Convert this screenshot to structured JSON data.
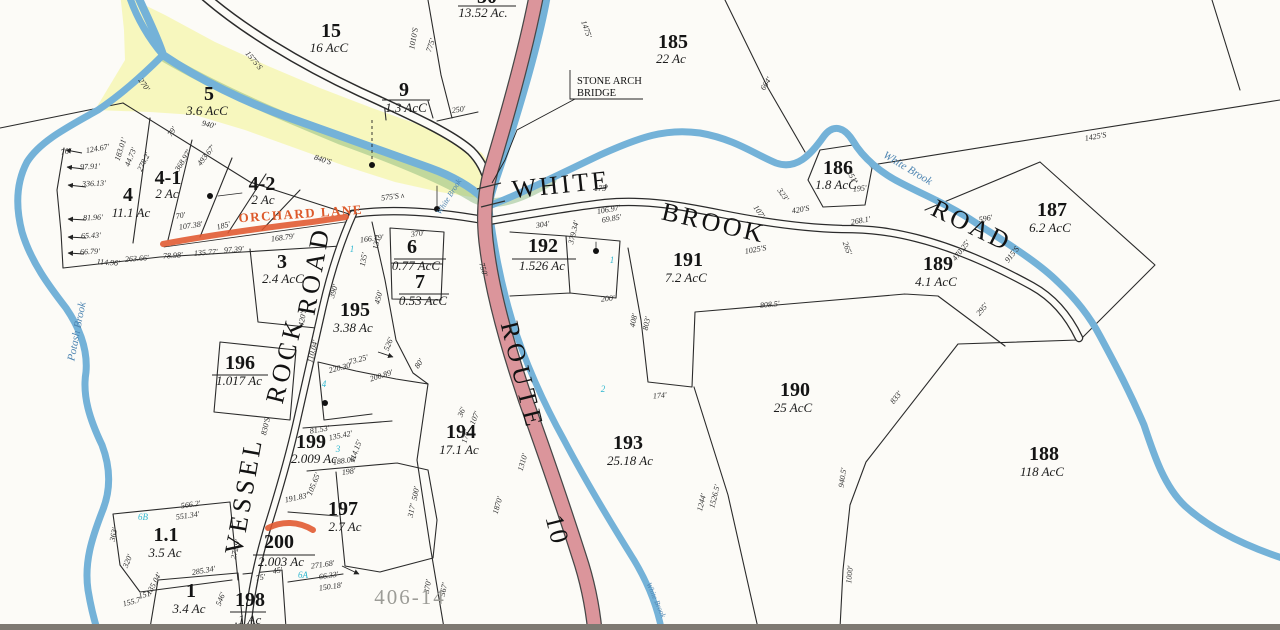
{
  "annotations": {
    "bridge_note_line1": "STONE ARCH",
    "bridge_note_line2": "BRIDGE",
    "sheet_ref": "406-14"
  },
  "colors": {
    "water": "#74b2d8",
    "route_fill": "#db959b",
    "floodplain": "#f7f7ba",
    "green_tinge": "#7fb274",
    "highlight": "#e0562e",
    "teal_marker": "#2fb7d0",
    "line": "#2b2b2b",
    "sheet_gray": "#9c9c97",
    "water_text": "#4e85b2"
  },
  "road_labels": [
    {
      "t": "WHITE",
      "x": 562,
      "y": 193,
      "r": -6,
      "s": 26,
      "ls": 3
    },
    {
      "t": "BROOK",
      "x": 712,
      "y": 231,
      "r": 13,
      "s": 26,
      "ls": 3
    },
    {
      "t": "ROAD",
      "x": 968,
      "y": 233,
      "r": 26,
      "s": 26,
      "ls": 3
    },
    {
      "t": "VESSEL",
      "x": 252,
      "y": 497,
      "r": -80,
      "s": 27,
      "ls": 4
    },
    {
      "t": "ROCK",
      "x": 293,
      "y": 362,
      "r": -76,
      "s": 27,
      "ls": 4
    },
    {
      "t": "ROAD",
      "x": 322,
      "y": 272,
      "r": -80,
      "s": 27,
      "ls": 4
    },
    {
      "t": "ROUTE",
      "x": 514,
      "y": 378,
      "r": 76,
      "s": 25,
      "ls": 5
    },
    {
      "t": "10",
      "x": 549,
      "y": 532,
      "r": 76,
      "s": 25,
      "ls": 2
    },
    {
      "t": "ORCHARD LANE",
      "x": 301,
      "y": 218,
      "r": -4,
      "s": 13,
      "ls": 1.5,
      "c": "#dd5a2b"
    }
  ],
  "water_labels": [
    {
      "t": "Potash Brook",
      "x": 80,
      "y": 332,
      "r": -79,
      "s": 11
    },
    {
      "t": "White Brook",
      "x": 906,
      "y": 171,
      "r": 31,
      "s": 11
    },
    {
      "t": "White Brook",
      "x": 451,
      "y": 198,
      "r": -58,
      "s": 8
    },
    {
      "t": "White Brook",
      "x": 654,
      "y": 601,
      "r": 66,
      "s": 7.5
    }
  ],
  "parcels": [
    {
      "id": "30",
      "ac": "13.52 Ac.",
      "x": 487,
      "y": 3,
      "ax": 483,
      "ay": 17
    },
    {
      "id": "15",
      "ac": "16 AcC",
      "x": 331,
      "y": 37,
      "ax": 329,
      "ay": 52
    },
    {
      "id": "5",
      "ac": "3.6 AcC",
      "x": 209,
      "y": 100,
      "ax": 207,
      "ay": 115
    },
    {
      "id": "9",
      "ac": "1.3 AcC",
      "x": 404,
      "y": 96,
      "ax": 406,
      "ay": 112
    },
    {
      "id": "185",
      "ac": "22 Ac",
      "x": 673,
      "y": 48,
      "ax": 671,
      "ay": 63
    },
    {
      "id": "186",
      "ac": "1.8 AcC",
      "x": 838,
      "y": 174,
      "ax": 836,
      "ay": 189
    },
    {
      "id": "187",
      "ac": "6.2 AcC",
      "x": 1052,
      "y": 216,
      "ax": 1050,
      "ay": 232
    },
    {
      "id": "189",
      "ac": "4.1 AcC",
      "x": 938,
      "y": 270,
      "ax": 936,
      "ay": 286
    },
    {
      "id": "191",
      "ac": "7.2 AcC",
      "x": 688,
      "y": 266,
      "ax": 686,
      "ay": 282
    },
    {
      "id": "192",
      "ac": "1.526 Ac",
      "x": 543,
      "y": 252,
      "ax": 542,
      "ay": 270
    },
    {
      "id": "4",
      "ac": "11.1 Ac",
      "x": 128,
      "y": 201,
      "ax": 131,
      "ay": 217
    },
    {
      "id": "4-1",
      "ac": "2 Ac",
      "x": 168,
      "y": 184,
      "ax": 167,
      "ay": 198
    },
    {
      "id": "4-2",
      "ac": "2 Ac",
      "x": 262,
      "y": 190,
      "ax": 263,
      "ay": 204
    },
    {
      "id": "3",
      "ac": "2.4 AcC",
      "x": 282,
      "y": 268,
      "ax": 283,
      "ay": 283
    },
    {
      "id": "6",
      "ac": "0.77 AcC",
      "x": 412,
      "y": 253,
      "ax": 416,
      "ay": 270
    },
    {
      "id": "7",
      "ac": "0.53 AcC",
      "x": 420,
      "y": 288,
      "ax": 423,
      "ay": 305
    },
    {
      "id": "195",
      "ac": "3.38 Ac",
      "x": 355,
      "y": 316,
      "ax": 353,
      "ay": 332
    },
    {
      "id": "196",
      "ac": "1.017 Ac",
      "x": 240,
      "y": 369,
      "ax": 239,
      "ay": 385
    },
    {
      "id": "199",
      "ac": "2.009 Ac",
      "x": 311,
      "y": 448,
      "ax": 314,
      "ay": 463
    },
    {
      "id": "197",
      "ac": "2.7 Ac",
      "x": 343,
      "y": 515,
      "ax": 345,
      "ay": 531
    },
    {
      "id": "200",
      "ac": "2.003 Ac",
      "x": 279,
      "y": 548,
      "ax": 281,
      "ay": 566
    },
    {
      "id": "1.1",
      "ac": "3.5 Ac",
      "x": 166,
      "y": 541,
      "ax": 165,
      "ay": 557
    },
    {
      "id": "1",
      "ac": "3.4 Ac",
      "x": 191,
      "y": 597,
      "ax": 189,
      "ay": 613
    },
    {
      "id": "198",
      "ac": ".1 Ac",
      "x": 250,
      "y": 606,
      "ax": 248,
      "ay": 624
    },
    {
      "id": "194",
      "ac": "17.1 Ac",
      "x": 461,
      "y": 438,
      "ax": 459,
      "ay": 454
    },
    {
      "id": "193",
      "ac": "25.18 Ac",
      "x": 628,
      "y": 449,
      "ax": 630,
      "ay": 465
    },
    {
      "id": "190",
      "ac": "25 AcC",
      "x": 795,
      "y": 396,
      "ax": 793,
      "ay": 412
    },
    {
      "id": "188",
      "ac": "118 AcC",
      "x": 1044,
      "y": 460,
      "ax": 1042,
      "ay": 476
    }
  ],
  "measurements": [
    {
      "t": "76'",
      "x": 66,
      "y": 154,
      "r": -10
    },
    {
      "t": "124.67'",
      "x": 98,
      "y": 151,
      "r": -10
    },
    {
      "t": "97.91'",
      "x": 90,
      "y": 169,
      "r": -2
    },
    {
      "t": "336.13'",
      "x": 94,
      "y": 186,
      "r": -2
    },
    {
      "t": "81.96'",
      "x": 93,
      "y": 220,
      "r": -2
    },
    {
      "t": "65.43'",
      "x": 91,
      "y": 238,
      "r": -2
    },
    {
      "t": "66.79'",
      "x": 90,
      "y": 254,
      "r": -2
    },
    {
      "t": "114.96'",
      "x": 108,
      "y": 265,
      "r": 4
    },
    {
      "t": "263.66'",
      "x": 137,
      "y": 261,
      "r": -4
    },
    {
      "t": "78.98'",
      "x": 173,
      "y": 258,
      "r": -4
    },
    {
      "t": "135.77'",
      "x": 206,
      "y": 255,
      "r": -4
    },
    {
      "t": "97.39'",
      "x": 234,
      "y": 252,
      "r": -4
    },
    {
      "t": "183.01'",
      "x": 123,
      "y": 150,
      "r": -72,
      "s": 6.5
    },
    {
      "t": "44.73'",
      "x": 133,
      "y": 158,
      "r": -68,
      "s": 6.5
    },
    {
      "t": "278.2'",
      "x": 146,
      "y": 163,
      "r": -64,
      "s": 6.5
    },
    {
      "t": "79'",
      "x": 174,
      "y": 133,
      "r": -55,
      "s": 6.5
    },
    {
      "t": "368.97'",
      "x": 185,
      "y": 162,
      "r": -58,
      "s": 6.5
    },
    {
      "t": "493.67'",
      "x": 208,
      "y": 157,
      "r": -52,
      "s": 6.5
    },
    {
      "t": "70'",
      "x": 181,
      "y": 218,
      "r": -10,
      "s": 6.5
    },
    {
      "t": "107.38'",
      "x": 191,
      "y": 228,
      "r": -8,
      "s": 6.5
    },
    {
      "t": "185'",
      "x": 224,
      "y": 228,
      "r": -15,
      "s": 6.5
    },
    {
      "t": "270'",
      "x": 142,
      "y": 86,
      "r": 55
    },
    {
      "t": "940'",
      "x": 208,
      "y": 127,
      "r": 14
    },
    {
      "t": "1575'S",
      "x": 252,
      "y": 62,
      "r": 50
    },
    {
      "t": "1010'S",
      "x": 416,
      "y": 39,
      "r": -80
    },
    {
      "t": "775'",
      "x": 433,
      "y": 46,
      "r": -72
    },
    {
      "t": "1475'",
      "x": 584,
      "y": 30,
      "r": 70
    },
    {
      "t": "250'",
      "x": 459,
      "y": 112,
      "r": -8
    },
    {
      "t": "840'S",
      "x": 322,
      "y": 162,
      "r": 18
    },
    {
      "t": "575'S ʌ",
      "x": 393,
      "y": 199,
      "r": -8
    },
    {
      "t": "168.79'",
      "x": 283,
      "y": 240,
      "r": -7
    },
    {
      "t": "166.79'",
      "x": 372,
      "y": 241,
      "r": -7
    },
    {
      "t": "175'",
      "x": 601,
      "y": 191,
      "r": 0
    },
    {
      "t": "304'",
      "x": 543,
      "y": 227,
      "r": -8
    },
    {
      "t": "379.34'",
      "x": 576,
      "y": 233,
      "r": -76
    },
    {
      "t": "106.97'",
      "x": 609,
      "y": 212,
      "r": -10,
      "s": 6
    },
    {
      "t": "69.85'",
      "x": 612,
      "y": 221,
      "r": -10,
      "s": 6
    },
    {
      "t": "750'",
      "x": 481,
      "y": 270,
      "r": 74
    },
    {
      "t": "370'",
      "x": 418,
      "y": 236,
      "r": -8
    },
    {
      "t": "131'",
      "x": 379,
      "y": 243,
      "r": -80
    },
    {
      "t": "135'",
      "x": 366,
      "y": 260,
      "r": -80
    },
    {
      "t": "390'",
      "x": 336,
      "y": 292,
      "r": -72
    },
    {
      "t": "450'",
      "x": 381,
      "y": 298,
      "r": -76
    },
    {
      "t": "420'S",
      "x": 305,
      "y": 318,
      "r": -80
    },
    {
      "t": "110.04'",
      "x": 315,
      "y": 352,
      "r": -76
    },
    {
      "t": "526'",
      "x": 391,
      "y": 345,
      "r": -68
    },
    {
      "t": "80'",
      "x": 421,
      "y": 365,
      "r": -55,
      "s": 6.5
    },
    {
      "t": "73.25'",
      "x": 359,
      "y": 362,
      "r": -15
    },
    {
      "t": "220.30'",
      "x": 341,
      "y": 370,
      "r": -15
    },
    {
      "t": "200.89'",
      "x": 382,
      "y": 378,
      "r": -18
    },
    {
      "t": "830'S",
      "x": 268,
      "y": 427,
      "r": -76
    },
    {
      "t": "36'",
      "x": 464,
      "y": 413,
      "r": -68,
      "s": 6
    },
    {
      "t": "107'",
      "x": 477,
      "y": 419,
      "r": -68,
      "s": 6.5
    },
    {
      "t": "175'",
      "x": 468,
      "y": 437,
      "r": -76,
      "s": 6.5
    },
    {
      "t": "500'",
      "x": 418,
      "y": 494,
      "r": -80
    },
    {
      "t": "317'",
      "x": 414,
      "y": 511,
      "r": -78
    },
    {
      "t": "1310'",
      "x": 525,
      "y": 463,
      "r": -74
    },
    {
      "t": "1870'",
      "x": 500,
      "y": 506,
      "r": -74
    },
    {
      "t": "370'",
      "x": 430,
      "y": 587,
      "r": -80
    },
    {
      "t": "567'",
      "x": 446,
      "y": 590,
      "r": -78
    },
    {
      "t": "200'",
      "x": 608,
      "y": 301,
      "r": -5
    },
    {
      "t": "408'",
      "x": 636,
      "y": 321,
      "r": -78
    },
    {
      "t": "803'",
      "x": 649,
      "y": 324,
      "r": -78
    },
    {
      "t": "174'",
      "x": 660,
      "y": 398,
      "r": -5
    },
    {
      "t": "664'",
      "x": 768,
      "y": 85,
      "r": -58
    },
    {
      "t": "1425'S",
      "x": 1096,
      "y": 139,
      "r": -10
    },
    {
      "t": "596'",
      "x": 986,
      "y": 221,
      "r": -10
    },
    {
      "t": "251'",
      "x": 850,
      "y": 178,
      "r": 58
    },
    {
      "t": "195'",
      "x": 860,
      "y": 191,
      "r": -5
    },
    {
      "t": "323'",
      "x": 781,
      "y": 196,
      "r": 55
    },
    {
      "t": "107'",
      "x": 757,
      "y": 213,
      "r": 55
    },
    {
      "t": "420'S",
      "x": 801,
      "y": 212,
      "r": -10
    },
    {
      "t": "268.1'",
      "x": 861,
      "y": 223,
      "r": -10
    },
    {
      "t": "1025'S",
      "x": 756,
      "y": 252,
      "r": -10
    },
    {
      "t": "470.25'",
      "x": 963,
      "y": 252,
      "r": -52
    },
    {
      "t": "915'S",
      "x": 1014,
      "y": 256,
      "r": -52
    },
    {
      "t": "295'",
      "x": 984,
      "y": 311,
      "r": -50
    },
    {
      "t": "265'",
      "x": 845,
      "y": 249,
      "r": 70
    },
    {
      "t": "808.5'",
      "x": 770,
      "y": 307,
      "r": -6
    },
    {
      "t": "833'",
      "x": 898,
      "y": 399,
      "r": -52
    },
    {
      "t": "940.5'",
      "x": 845,
      "y": 478,
      "r": -82
    },
    {
      "t": "1000'",
      "x": 852,
      "y": 575,
      "r": -84
    },
    {
      "t": "1526.5'",
      "x": 717,
      "y": 497,
      "r": -76
    },
    {
      "t": "1244'",
      "x": 704,
      "y": 503,
      "r": -76
    },
    {
      "t": "566.2'",
      "x": 191,
      "y": 507,
      "r": -8
    },
    {
      "t": "551.34'",
      "x": 188,
      "y": 518,
      "r": -8
    },
    {
      "t": "363'",
      "x": 116,
      "y": 535,
      "r": -78
    },
    {
      "t": "320'",
      "x": 130,
      "y": 562,
      "r": -68
    },
    {
      "t": "285.34'",
      "x": 204,
      "y": 573,
      "r": -10
    },
    {
      "t": "135.04'",
      "x": 156,
      "y": 585,
      "r": -62
    },
    {
      "t": "151'",
      "x": 146,
      "y": 597,
      "r": -15
    },
    {
      "t": "155.7'",
      "x": 133,
      "y": 604,
      "r": -15
    },
    {
      "t": "272.9'",
      "x": 238,
      "y": 550,
      "r": -76
    },
    {
      "t": "546'",
      "x": 223,
      "y": 600,
      "r": -68
    },
    {
      "t": "81.53'",
      "x": 320,
      "y": 432,
      "r": -10,
      "s": 6
    },
    {
      "t": "135.42'",
      "x": 341,
      "y": 438,
      "r": -12,
      "s": 6
    },
    {
      "t": "114.15'",
      "x": 358,
      "y": 452,
      "r": -70,
      "s": 6
    },
    {
      "t": "188.08'",
      "x": 345,
      "y": 463,
      "r": -8,
      "s": 6
    },
    {
      "t": "198'",
      "x": 349,
      "y": 474,
      "r": -8,
      "s": 6
    },
    {
      "t": "105.65'",
      "x": 316,
      "y": 485,
      "r": -68,
      "s": 6
    },
    {
      "t": "191.83'",
      "x": 297,
      "y": 500,
      "r": -12,
      "s": 6
    },
    {
      "t": "271.68'",
      "x": 323,
      "y": 567,
      "r": -8,
      "s": 6
    },
    {
      "t": "66.33'",
      "x": 329,
      "y": 578,
      "r": -8,
      "s": 6
    },
    {
      "t": "150.18'",
      "x": 331,
      "y": 589,
      "r": -8,
      "s": 6
    },
    {
      "t": "45'",
      "x": 278,
      "y": 573,
      "r": -10,
      "s": 6
    },
    {
      "t": "75'",
      "x": 261,
      "y": 580,
      "r": -10,
      "s": 6
    }
  ],
  "markers": {
    "teal": [
      {
        "t": "6B",
        "x": 143,
        "y": 520
      },
      {
        "t": "1",
        "x": 352,
        "y": 252
      },
      {
        "t": "4",
        "x": 324,
        "y": 387
      },
      {
        "t": "3",
        "x": 338,
        "y": 452
      },
      {
        "t": "6A",
        "x": 303,
        "y": 578
      },
      {
        "t": "2",
        "x": 603,
        "y": 392
      },
      {
        "t": "1",
        "x": 612,
        "y": 263
      }
    ],
    "dots": [
      {
        "x": 210,
        "y": 196
      },
      {
        "x": 437,
        "y": 209
      },
      {
        "x": 596,
        "y": 251
      },
      {
        "x": 325,
        "y": 403
      },
      {
        "x": 372,
        "y": 165
      }
    ]
  }
}
